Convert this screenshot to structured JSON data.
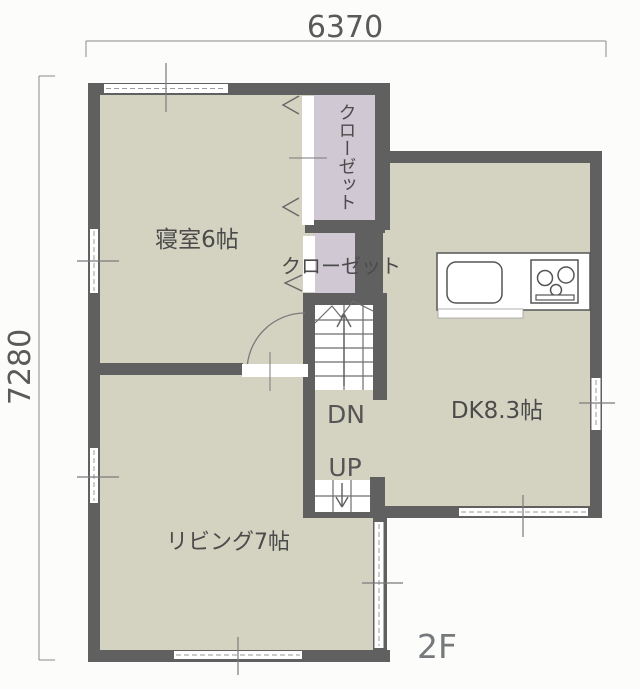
{
  "meta": {
    "floor_label": "2F"
  },
  "dimensions": {
    "top": "6370",
    "left": "7280"
  },
  "rooms": {
    "bedroom": "寝室6帖",
    "living": "リビング7帖",
    "dining_kitchen": "DK8.3帖",
    "closet_vertical": "クローゼット",
    "closet_horizontal": "クローゼット"
  },
  "stairs": {
    "down": "DN",
    "up": "UP"
  },
  "colors": {
    "wall": "#606060",
    "floor": "#d4d3c1",
    "closet_floor": "#d0c8d2",
    "paper": "#fcfcfa",
    "label_text": "#4b4b4b"
  }
}
